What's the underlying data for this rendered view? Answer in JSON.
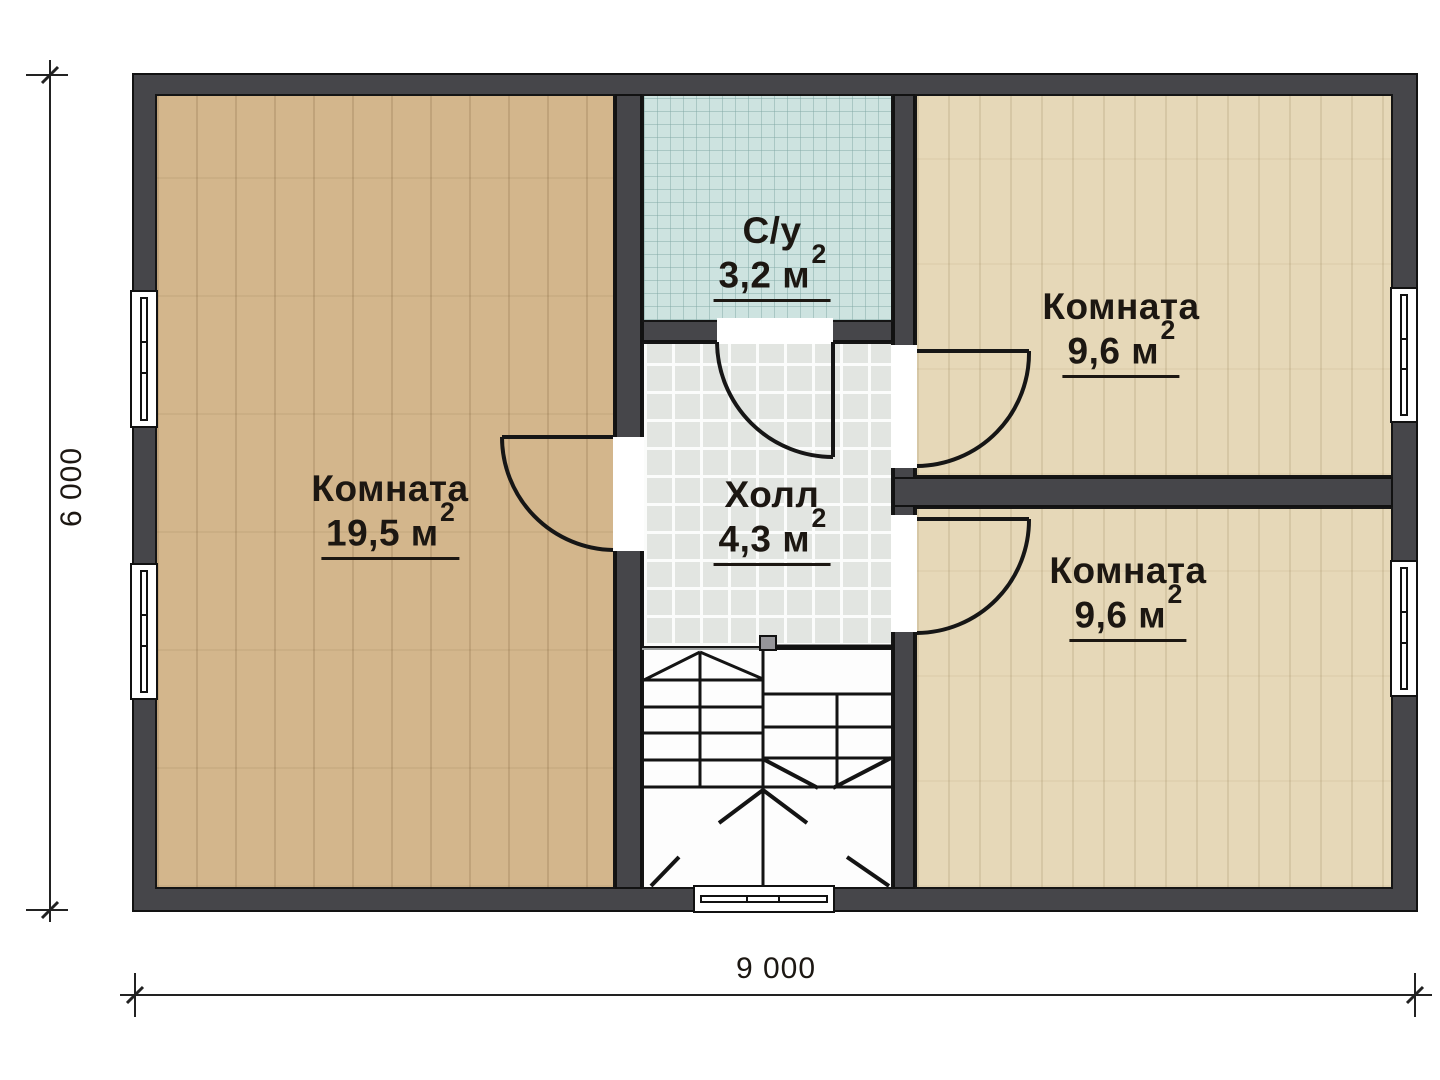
{
  "plan": {
    "rooms": [
      {
        "name": "Комната",
        "area": "19,5",
        "unit": "м",
        "sup": "2"
      },
      {
        "name": "С/у",
        "area": "3,2",
        "unit": "м",
        "sup": "2"
      },
      {
        "name": "Холл",
        "area": "4,3",
        "unit": "м",
        "sup": "2"
      },
      {
        "name": "Комната",
        "area": "9,6",
        "unit": "м",
        "sup": "2"
      },
      {
        "name": "Комната",
        "area": "9,6",
        "unit": "м",
        "sup": "2"
      }
    ],
    "dimensions": {
      "height_label": "6 000",
      "width_label": "9 000"
    },
    "colors": {
      "wall": "#46464a",
      "floor_left_room": "#d3b68c",
      "floor_right_rooms": "#e6d8b8",
      "floor_bathroom": "#cde3e0",
      "floor_hall": "#e2e5e1",
      "line": "#161616"
    }
  }
}
